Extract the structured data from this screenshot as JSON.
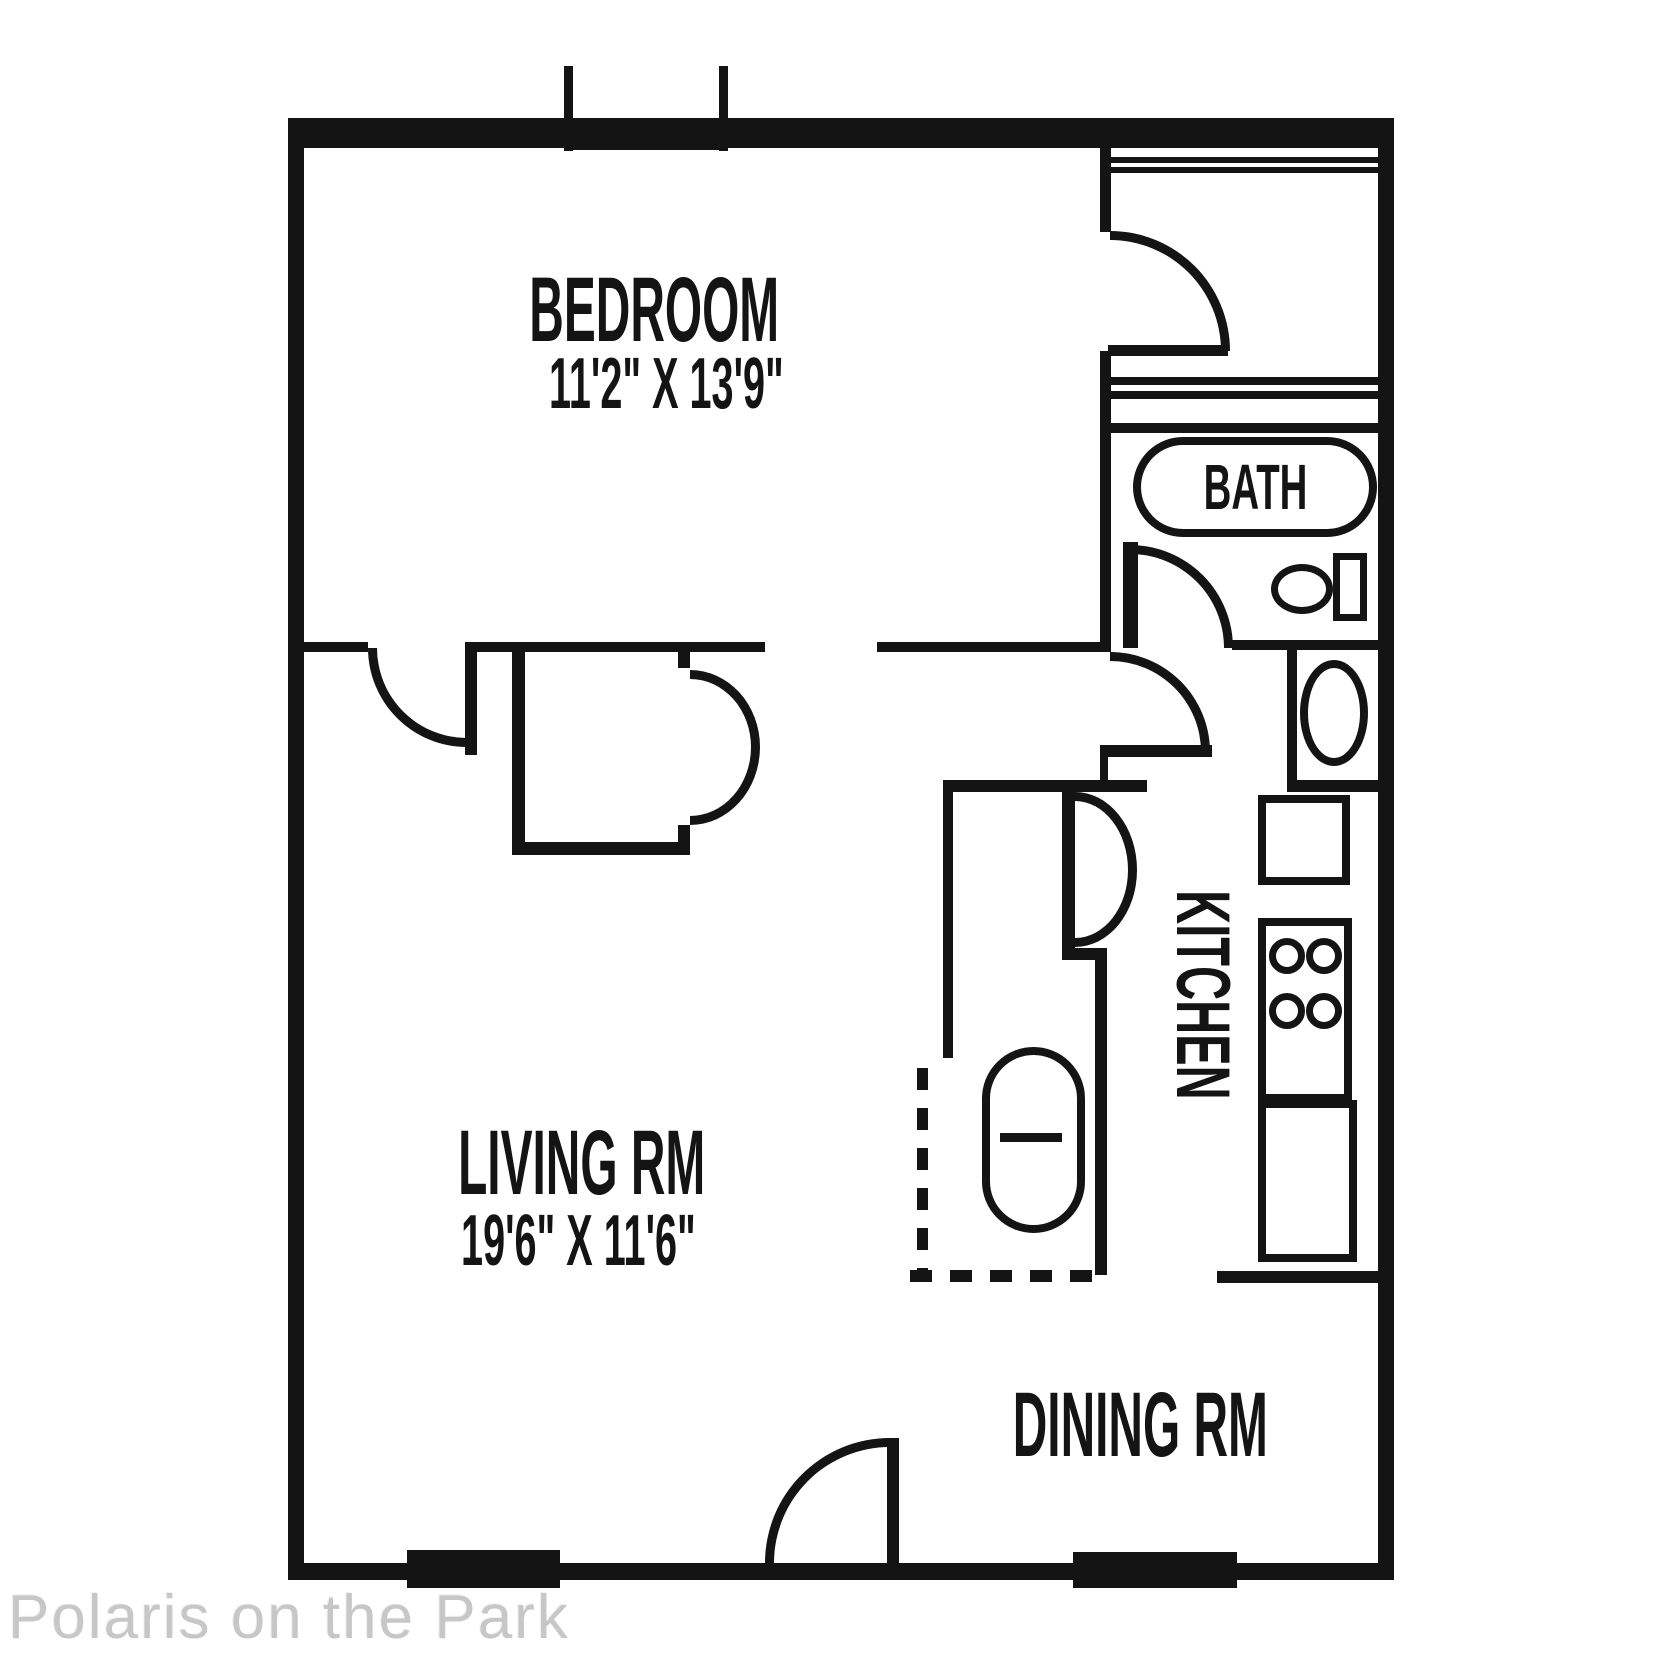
{
  "plan": {
    "watermark": "Polaris on the Park",
    "colors": {
      "line": "#141414",
      "watermark": "#c7c7c7",
      "background": "#ffffff"
    },
    "rooms": {
      "bedroom": {
        "label": "BEDROOM",
        "dims": "11'2\" X 13'9\""
      },
      "living": {
        "label": "LIVING RM",
        "dims": "19'6\" X 11'6\""
      },
      "dining": {
        "label": "DINING RM"
      },
      "kitchen": {
        "label": "KITCHEN"
      },
      "bath": {
        "label": "BATH"
      }
    }
  }
}
